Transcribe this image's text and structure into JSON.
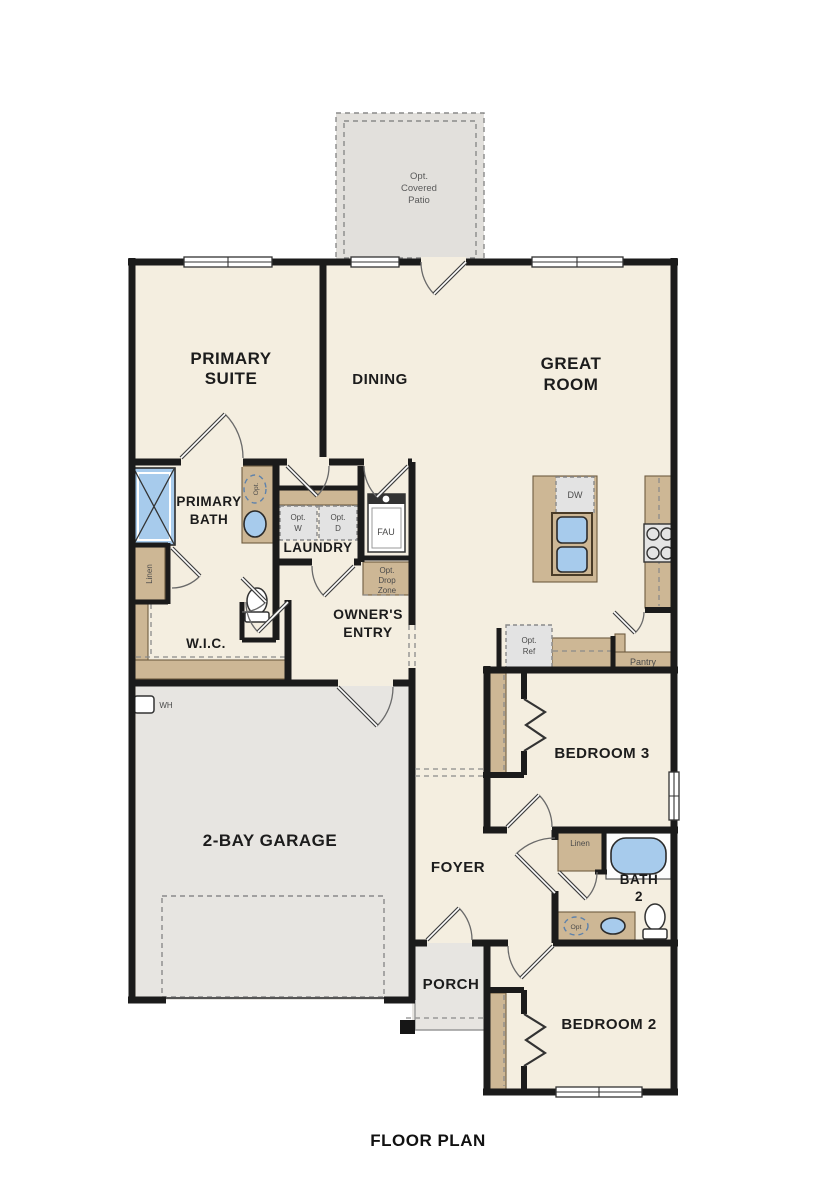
{
  "title": "FLOOR PLAN",
  "colors": {
    "wall": "#1b1b1b",
    "floor": "#f4eee0",
    "garage_floor": "#e7e5e1",
    "patio_floor": "#e2e0dc",
    "cabinet_tan": "#cdb795",
    "fixture_blue": "#a7cbec",
    "appliance_gray": "#e3e3e3"
  },
  "rooms": {
    "patio": {
      "lines": [
        "Opt.",
        "Covered",
        "Patio"
      ]
    },
    "primary_suite": {
      "lines": [
        "PRIMARY",
        "SUITE"
      ]
    },
    "dining": {
      "label": "DINING"
    },
    "great_room": {
      "lines": [
        "GREAT",
        "ROOM"
      ]
    },
    "primary_bath": {
      "lines": [
        "PRIMARY",
        "BATH"
      ]
    },
    "laundry": {
      "label": "LAUNDRY"
    },
    "wic": {
      "label": "W.I.C."
    },
    "owners_entry": {
      "lines": [
        "OWNER'S",
        "ENTRY"
      ]
    },
    "garage": {
      "label": "2-BAY GARAGE"
    },
    "foyer": {
      "label": "FOYER"
    },
    "bedroom3": {
      "label": "BEDROOM 3"
    },
    "bath2": {
      "lines": [
        "BATH",
        "2"
      ]
    },
    "bedroom2": {
      "label": "BEDROOM 2"
    },
    "porch": {
      "label": "PORCH"
    },
    "pantry": {
      "label": "Pantry"
    }
  },
  "fixtures": {
    "dw": "DW",
    "fau": "FAU",
    "wh": "WH",
    "opt_washer": [
      "Opt.",
      "W"
    ],
    "opt_dryer": [
      "Opt.",
      "D"
    ],
    "opt_ref": [
      "Opt.",
      "Ref"
    ],
    "drop_zone": [
      "Opt.",
      "Drop",
      "Zone"
    ],
    "linen_primary": "Linen",
    "linen_bath2": "Linen",
    "opt_sink_primary": "Opt.",
    "opt_sink_bath2": "Opt"
  }
}
